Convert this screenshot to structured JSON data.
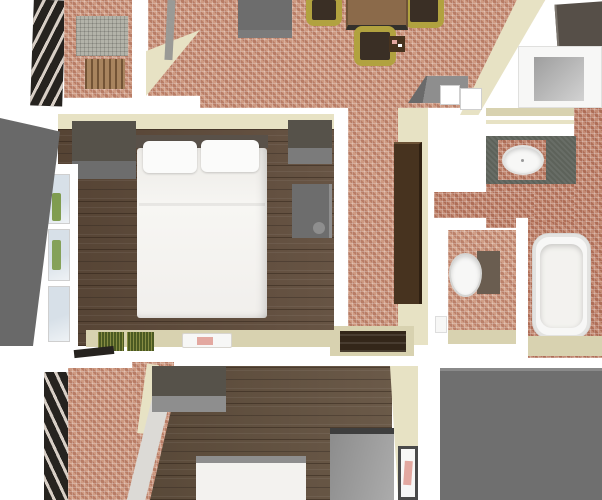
{
  "scene": {
    "type": "3d-floorplan-render",
    "description": "Top-down 3D rendering of an apartment floor plan with terracotta tile and dark wood floors",
    "rooms": [
      {
        "name": "upper-balcony",
        "floor": "terracotta-tile",
        "objects": [
          "slatted-railing",
          "gray-woven-mat",
          "wooden-lounger"
        ]
      },
      {
        "name": "living-dining-room",
        "floor": "terracotta-tile",
        "objects": [
          "gray-sideboard",
          "wood-dining-table",
          "olive-chairs",
          "kitchen-unit",
          "white-appliance-boxes",
          "small-dark-shelf"
        ]
      },
      {
        "name": "master-bedroom",
        "floor": "dark-wood",
        "objects": [
          "double-bed",
          "two-pillows",
          "gray-wardrobe",
          "gray-cabinet-1",
          "gray-cabinet-2",
          "window-wall",
          "green-doormats",
          "white-book"
        ]
      },
      {
        "name": "hallway",
        "floor": "terracotta-tile",
        "objects": [
          "tall-brown-wardrobe",
          "dark-stair-recess"
        ]
      },
      {
        "name": "vanity-bathroom",
        "floor": "terracotta-tile",
        "objects": [
          "shower-cabin",
          "green-vanity-counter",
          "round-white-sink"
        ]
      },
      {
        "name": "wc-bathroom",
        "floor": "terracotta-tile",
        "objects": [
          "toilet",
          "bathtub",
          "small-white-fixture"
        ]
      },
      {
        "name": "lower-balcony",
        "floor": "terracotta-tile",
        "objects": [
          "slatted-railing"
        ]
      },
      {
        "name": "second-bedroom",
        "floor": "dark-wood",
        "objects": [
          "bed",
          "gray-dresser",
          "gray-tall-cabinet",
          "leaning-picture"
        ]
      },
      {
        "name": "flat-roof",
        "floor": "plain-gray",
        "objects": []
      }
    ]
  },
  "palette": {
    "white": "#ffffff",
    "tile_base": "#c68e76",
    "tile_red": "#b97b64",
    "tile_light": "#c9937b",
    "wood": "#5f4b3a",
    "wood2": "#63513f",
    "beige": "#e7e2c4",
    "beige_dark": "#d8d2b0",
    "gray_roof": "#6f6f6f",
    "gray_wedge": "#696969",
    "gray_cab_dark": "#56524a",
    "gray_cab": "#6d6d6d",
    "gray_cab_mid": "#7b7b7b",
    "gray_cab_light": "#8e8e8e",
    "fridge_gray": "#a0a0a0",
    "slab": "#564f48",
    "railing": "#26231f",
    "counter_green": "#5d625a",
    "brown_wardrobe": "#47331f",
    "table_wood": "#8b6a4a",
    "chair_olive": "#b1a23f",
    "chair_seat": "#3a2f25",
    "headboard": "#595149",
    "bed_white": "#f3f2ef",
    "pillow_white": "#fbfbfa",
    "glass_blue": "#d7e0e8",
    "view_green": "#76953f",
    "mat_green": "#4b5a22",
    "lounger_wood": "#a8845e",
    "mat_gray": "#b3b3a9",
    "tank_brown": "#6a5d50",
    "recess_dark": "#332619",
    "pole_gray": "#9a9a96",
    "pic_pink": "#e3a8a0",
    "fixture_white": "#f7f7f6"
  }
}
